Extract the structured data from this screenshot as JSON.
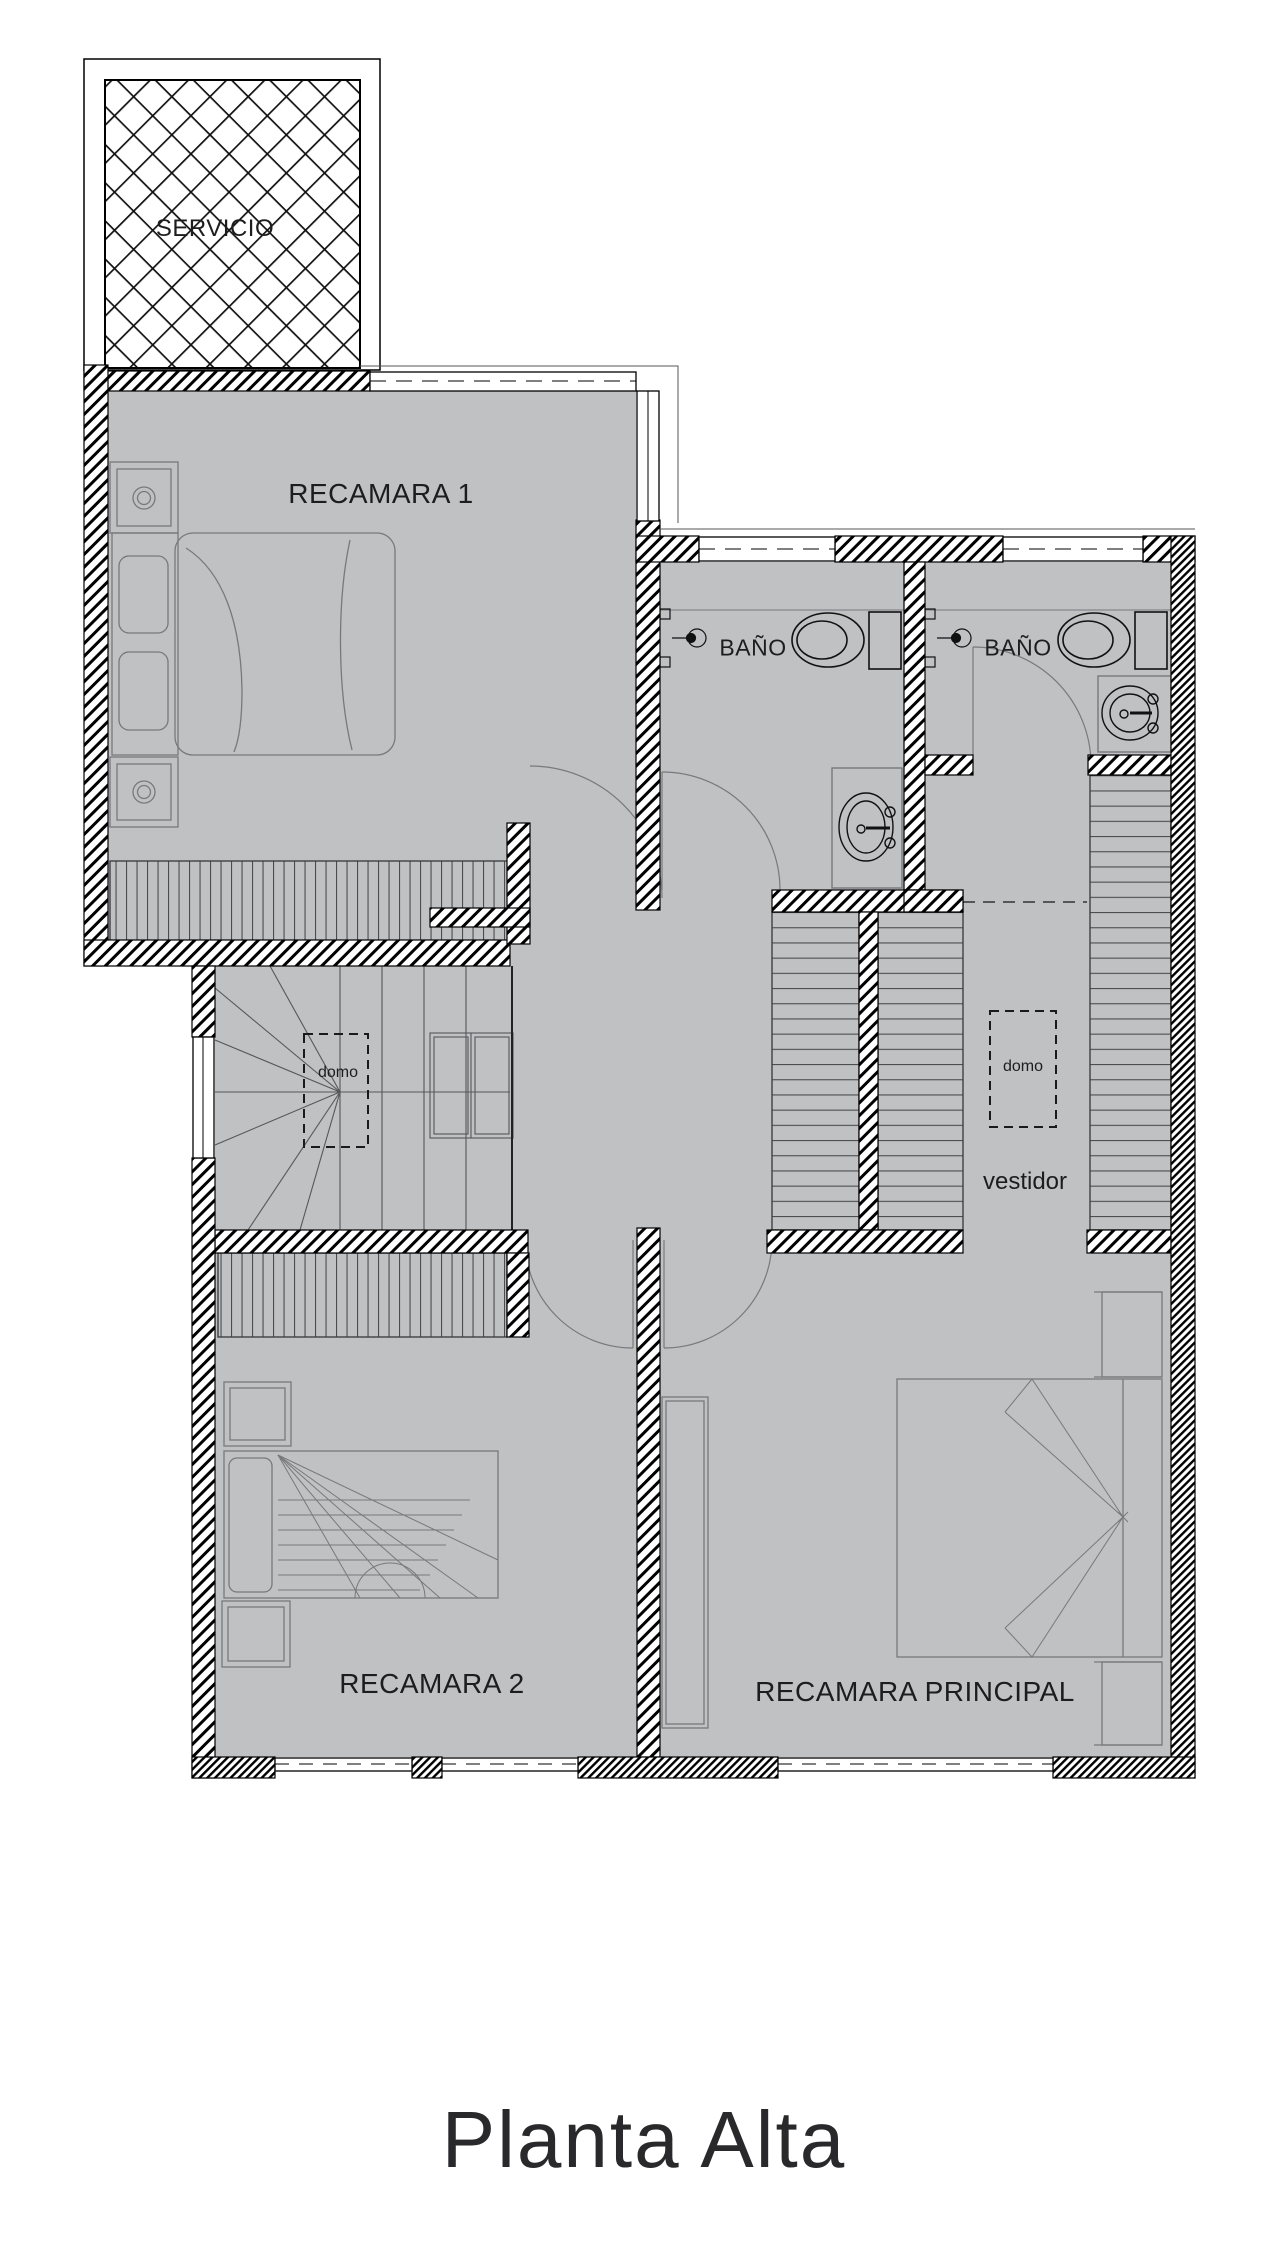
{
  "title": {
    "text": "Planta Alta"
  },
  "rooms": {
    "servicio": {
      "label": "SERVICIO"
    },
    "recamara1": {
      "label": "RECAMARA 1"
    },
    "bano1": {
      "label": "BAÑO"
    },
    "bano2": {
      "label": "BAÑO"
    },
    "vestidor": {
      "label": "vestidor"
    },
    "recamara2": {
      "label": "RECAMARA 2"
    },
    "principal": {
      "label": "RECAMARA PRINCIPAL"
    }
  },
  "annotations": {
    "domo_stairs": {
      "label": "domo"
    },
    "domo_vestidor": {
      "label": "domo"
    }
  },
  "colors": {
    "floor": "#bfc1c3",
    "wall_line": "#000000",
    "furniture_line": "#77797c",
    "text": "#1d1d1f"
  }
}
